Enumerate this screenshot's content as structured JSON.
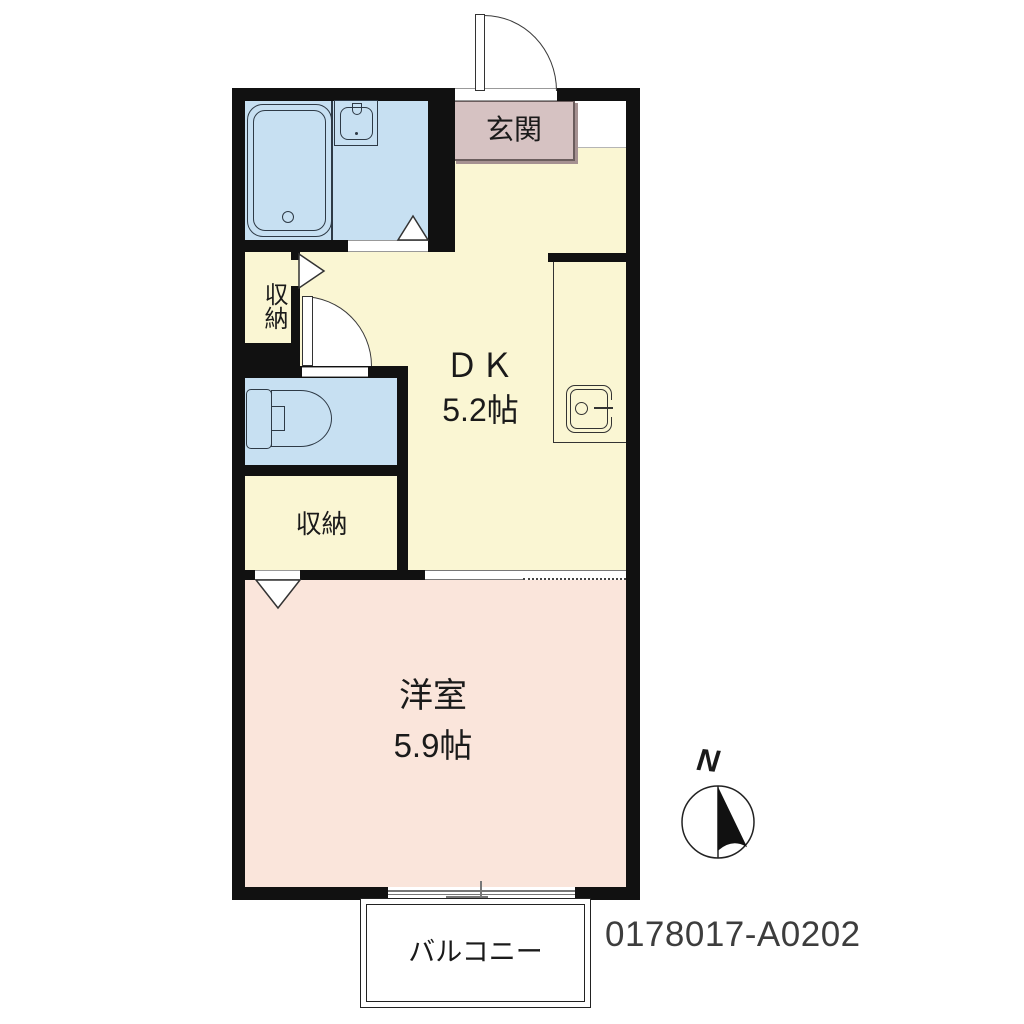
{
  "rooms": {
    "entrance": {
      "label": "玄関"
    },
    "dk": {
      "label": "ＤＫ",
      "area": "5.2帖"
    },
    "western": {
      "label": "洋室",
      "area": "5.9帖"
    },
    "storage_upper": {
      "label": "収納"
    },
    "storage_lower": {
      "label": "収納"
    },
    "balcony": {
      "label": "バルコニー"
    }
  },
  "compass": {
    "north_label": "N"
  },
  "property_id": "0178017-A0202",
  "colors": {
    "wall": "#111111",
    "living_yellow": "#FAF6D3",
    "wet_area_blue": "#C7E0F2",
    "bedroom_pink": "#FAE5DB",
    "entrance_mauve": "#D6C2C2",
    "background": "#FFFFFF"
  }
}
